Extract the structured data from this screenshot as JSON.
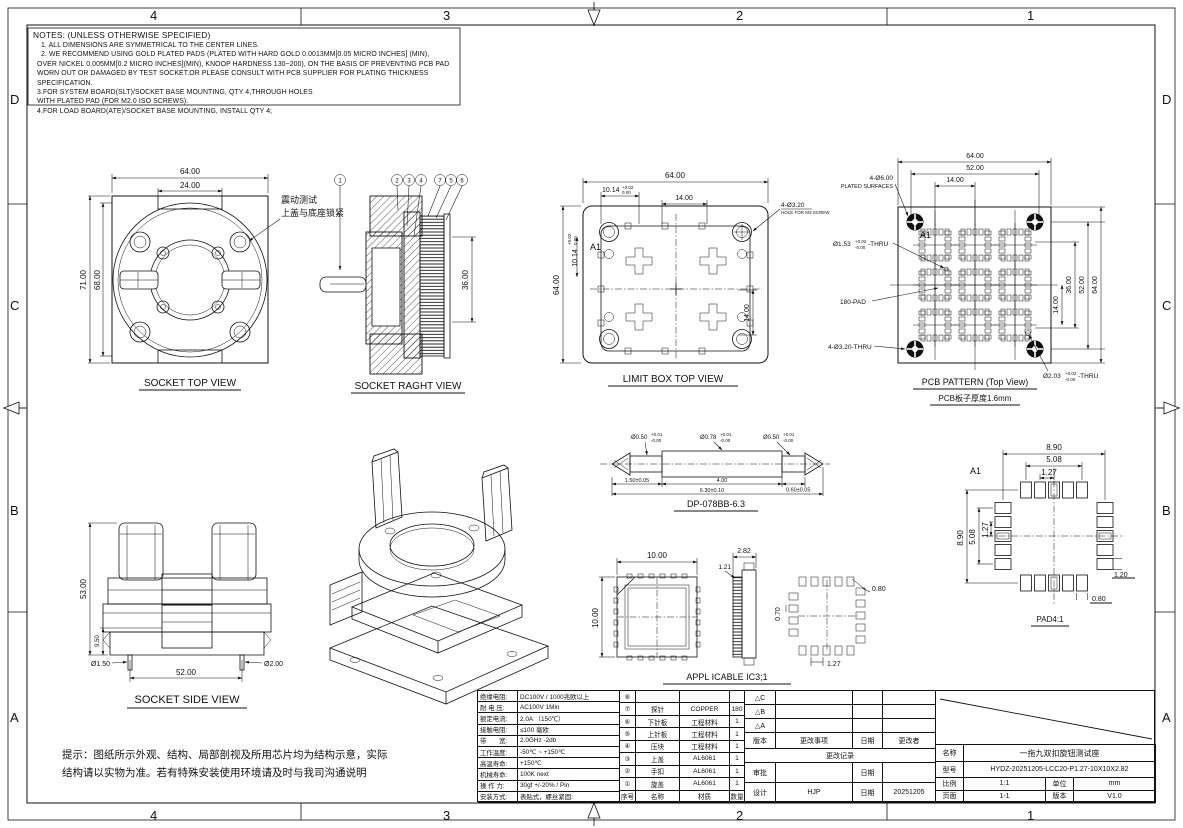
{
  "drawing": {
    "zones_top": [
      "4",
      "3",
      "2",
      "1"
    ],
    "zones_bottom": [
      "4",
      "3",
      "2",
      "1"
    ],
    "zones_left": [
      "D",
      "C",
      "B",
      "A"
    ],
    "zones_right": [
      "D",
      "C",
      "B",
      "A"
    ]
  },
  "notes": {
    "title": "NOTES: (UNLESS OTHERWISE SPECIFIED)",
    "line1": "1. ALL DIMENSIONS ARE SYMMETRICAL TO THE CENTER LINES.",
    "line2": "2. WE RECOMMEND USING GOLD PLATED PADS (PLATED WITH HARD GOLD 0.0013MM[0.05 MICRO INCHES] (MIN),",
    "line3": "OVER NICKEL 0.005MM[0.2 MICRO INCHES](MIN), KNOOP HARDNESS 130~200), ON THE BASIS OF PREVENTING PCB PAD",
    "line4": "WORN OUT OR DAMAGED BY TEST SOCKET.OR PLEASE CONSULT WITH PCB SUPPLIER FOR PLATING THICKNESS SPECIFICATION.",
    "line5": "3.FOR SYSTEM BOARD(SLT)/SOCKET BASE MOUNTING, QTY 4,THROUGH HOLES",
    "line6": "WITH PLATED PAD (FOR M2.0 ISO SCREWS).",
    "line7": "4.FOR LOAD BOARD(ATE)/SOCKET BASE MOUNTING, INSTALL QTY 4;"
  },
  "socket_top": {
    "label": "SOCKET TOP VIEW",
    "dim_width": "64.00",
    "dim_tab": "24.00",
    "dim_height": "71.00",
    "dim_inner_height": "68.00",
    "note_line1": "震动测试",
    "note_line2": "上盖与底座锁紧"
  },
  "socket_right": {
    "label": "SOCKET RAGHT VIEW",
    "dim_height": "36.00",
    "balloon_shaft": "1",
    "balloon_2": "2",
    "balloon_3": "3",
    "balloon_4": "4",
    "balloon_5": "7",
    "balloon_6": "5",
    "balloon_7": "6"
  },
  "limit_box": {
    "label": "LIMIT BOX  TOP VIEW",
    "dim_width": "64.00",
    "dim_height": "64.00",
    "dim_pocket": "10.14",
    "tol_up": "+0.02",
    "tol_dn": "0.00",
    "dim_pitch_top": "14.00",
    "dim_pitch_right": "14.00",
    "marker_a1": "A1",
    "callout_hole": "4-Ø3.20",
    "callout_hole2": "HOLE FOR M3 SCREW"
  },
  "pcb": {
    "label": "PCB PATTERN (Top View)",
    "sublabel": "PCB板子厚度1.6mm",
    "dim_w1": "64.00",
    "dim_w2": "52.00",
    "dim_w3": "14.00",
    "dim_h1": "64.00",
    "dim_h2": "52.00",
    "dim_h3": "36.00",
    "dim_h4": "14.00",
    "callout_plated1": "4-Ø6.00",
    "callout_plated2": "PLATED SURFACES",
    "callout_via": "Ø1.53",
    "callout_via_tol_up": "+0.02",
    "callout_via_tol_dn": "-0.00",
    "callout_via_suffix": "-THRU",
    "callout_pads": "180-PAD",
    "callout_mnt": "4-Ø3.20-THRU",
    "callout_guide": "Ø2.03",
    "callout_guide_tol_up": "+0.02",
    "callout_guide_tol_dn": "-0.00",
    "callout_guide_suffix": "-THRU",
    "marker_a1": "A1"
  },
  "probe": {
    "label": "DP-078BB-6.3",
    "dia_left": "Ø0.50",
    "dia_mid": "Ø0.78",
    "dia_right": "Ø0.50",
    "tol_up": "+0.01",
    "tol_dn": "-0.00",
    "dim_left": "1.50±0.05",
    "dim_mid": "4.00",
    "dim_right": "0.60±0.05",
    "dim_total": "6.30±0.10"
  },
  "socket_side": {
    "label": "SOCKET SIDE VIEW",
    "dim_height": "53.00",
    "dim_base": "9.50",
    "dim_pin1": "Ø1.50",
    "dim_pin2": "Ø2.00",
    "dim_width": "52.00"
  },
  "ic": {
    "label": "APPL ICABLE IC3;1",
    "dim_w": "10.00",
    "dim_h": "10.00",
    "dim_t": "2.82",
    "dim_t2": "1.21",
    "dim_pad_w": "0.80",
    "dim_pad_h": "0.70",
    "dim_pitch": "1.27"
  },
  "pad": {
    "label": "PAD4:1",
    "marker_a1": "A1",
    "dim_w1": "8.90",
    "dim_w2": "5.08",
    "dim_w3": "1.27",
    "dim_h1": "8.90",
    "dim_h2": "5.08",
    "dim_h3": "1.27",
    "dim_pad_l": "1.20",
    "dim_pad_w": "0.80"
  },
  "tip": {
    "line1": "提示：图纸所示外观、结构、局部剖视及所用芯片均为结构示意，实际",
    "line2": "结构请以实物为准。若有特殊安装使用环境请及时与我司沟通说明"
  },
  "title_block": {
    "specs": [
      {
        "label": "绝缘电阻:",
        "value": "DC100V / 1000兆欧以上"
      },
      {
        "label": "耐 电 压:",
        "value": "AC100V 1Min"
      },
      {
        "label": "额定电流:",
        "value": "2.0A （150℃）"
      },
      {
        "label": "接触电阻:",
        "value": "≤100 毫欧"
      },
      {
        "label": "带　　宽:",
        "value": "2.0GHz  -2db"
      },
      {
        "label": "工作温度:",
        "value": "-50℃ ~ +150℃"
      },
      {
        "label": "高温寿命:",
        "value": "+150℃"
      },
      {
        "label": "机械寿命:",
        "value": "100K next"
      },
      {
        "label": "操 作 力:",
        "value": "30gf +/-20% / Pin"
      },
      {
        "label": "安装方式:",
        "value": "表贴式，螺丝紧固:"
      }
    ],
    "bom_header": {
      "no": "序号",
      "name": "名称",
      "material": "材质",
      "qty": "数量"
    },
    "bom": [
      {
        "no": "⑧",
        "name": "",
        "material": "",
        "qty": ""
      },
      {
        "no": "⑦",
        "name": "探针",
        "material": "COPPER",
        "qty": "180"
      },
      {
        "no": "⑥",
        "name": "下针板",
        "material": "工程材料",
        "qty": "1"
      },
      {
        "no": "⑤",
        "name": "上针板",
        "material": "工程材料",
        "qty": "1"
      },
      {
        "no": "④",
        "name": "压块",
        "material": "工程材料",
        "qty": "1"
      },
      {
        "no": "③",
        "name": "上盖",
        "material": "AL6061",
        "qty": "1"
      },
      {
        "no": "②",
        "name": "手扣",
        "material": "AL6061",
        "qty": "1"
      },
      {
        "no": "①",
        "name": "旋盖",
        "material": "AL6061",
        "qty": "1"
      }
    ],
    "revision": {
      "delta_c": "△C",
      "delta_b": "△B",
      "delta_a": "△A",
      "header_version": "版本",
      "header_change": "更改事项",
      "header_date": "日期",
      "header_by": "更改者",
      "change_record": "更改记录",
      "approve_label": "审批",
      "approve_date_label": "日期",
      "approve_date": "",
      "design_label": "设计",
      "designer": "HJP",
      "design_date_label": "日期",
      "design_date": "20251205"
    },
    "info": {
      "name_label": "名称",
      "name": "一拖九双扣旋钮测试座",
      "model_label": "型号",
      "model": "HYDZ-20251205-LCC20-P1.27-10X10X2.82",
      "scale_label": "比例",
      "scale": "1:1",
      "unit_label": "单位",
      "unit": "mm",
      "page_label": "页面",
      "page": "1-1",
      "version_label": "版本",
      "version": "V1.0"
    }
  }
}
